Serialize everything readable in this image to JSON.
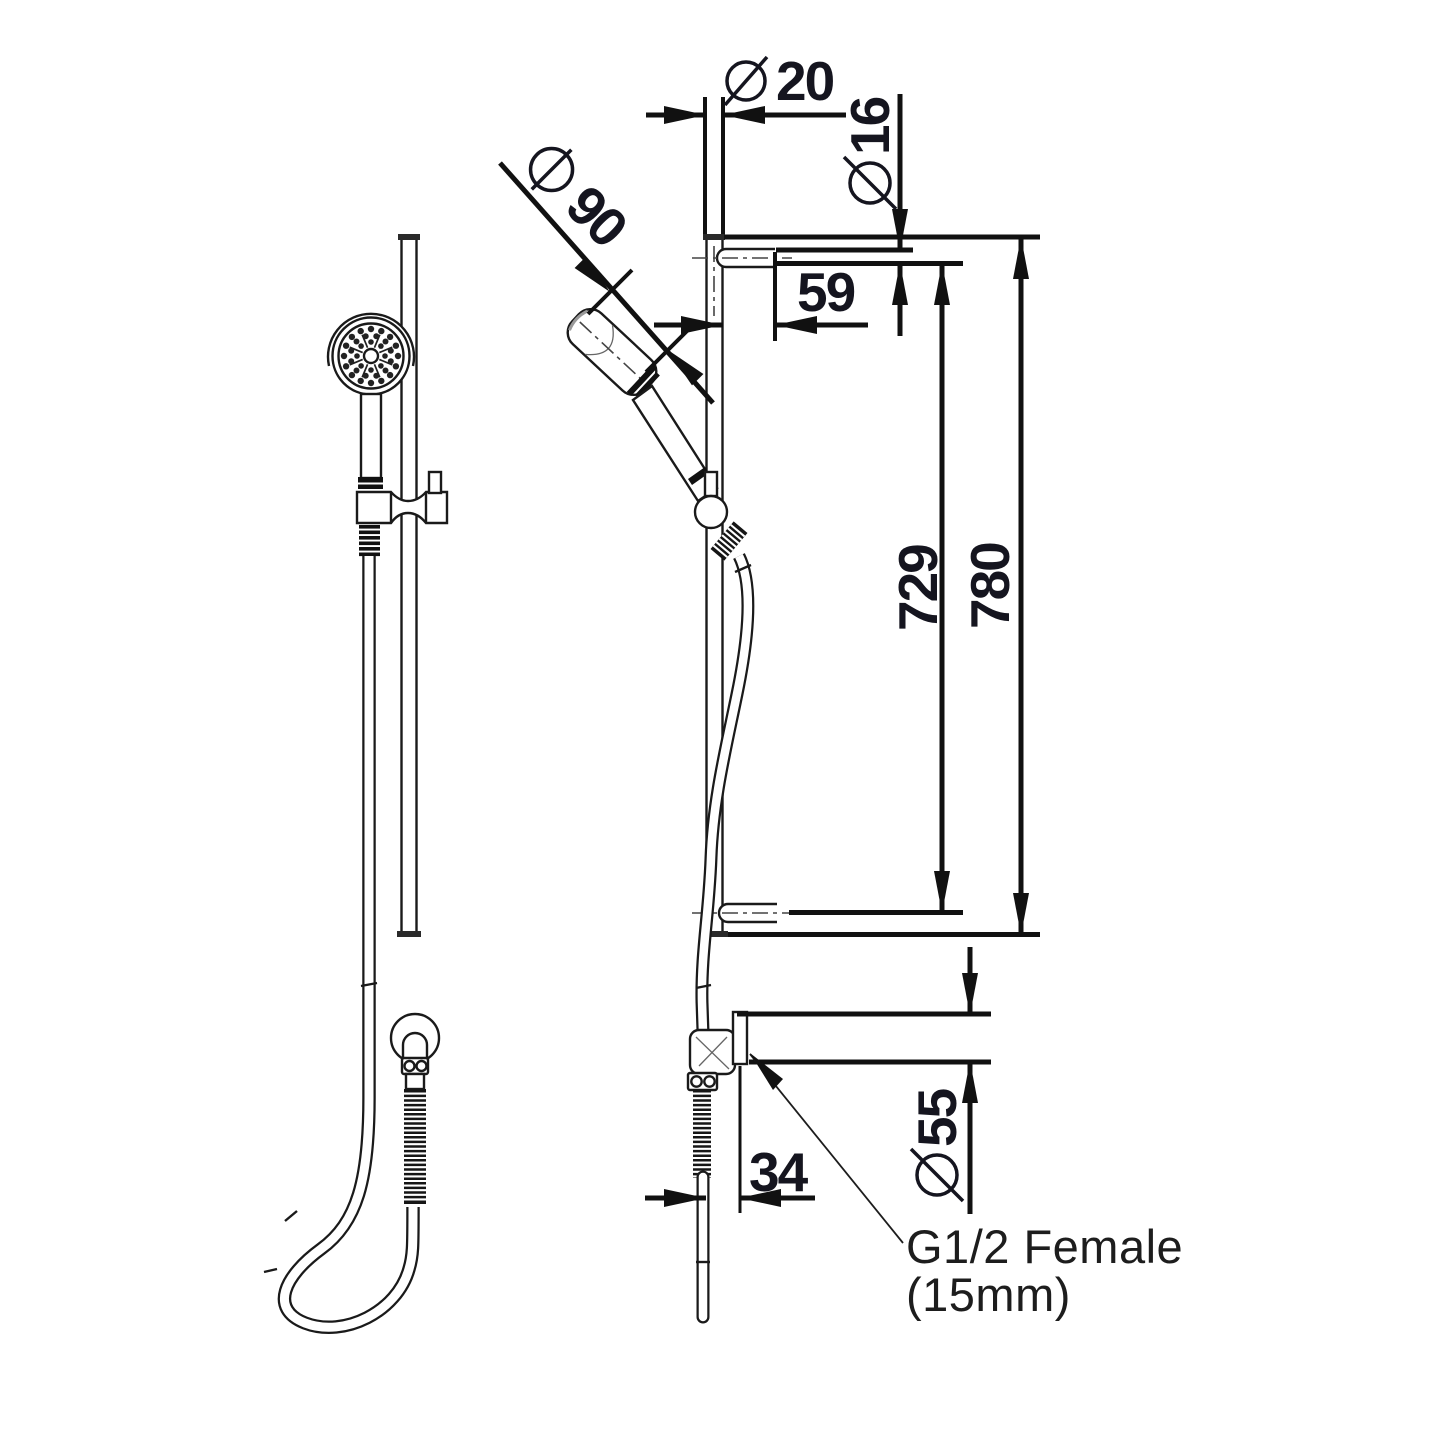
{
  "colors": {
    "background": "#ffffff",
    "line": "#1a1a1a",
    "dimension_text": "#15151f"
  },
  "dimensions": {
    "rail_diameter": {
      "symbol": "Ø",
      "value": "20"
    },
    "arm_diameter": {
      "symbol": "Ø",
      "value": "16"
    },
    "wall_offset": {
      "value": "59"
    },
    "handset_diameter": {
      "symbol": "Ø",
      "value": "90"
    },
    "bracket_spacing": {
      "value": "729"
    },
    "rail_length": {
      "value": "780"
    },
    "outlet_offset": {
      "value": "34"
    },
    "flange_diameter": {
      "symbol": "Ø",
      "value": "55"
    },
    "connection_note": {
      "line1": "G1/2 Female",
      "line2": "(15mm)"
    }
  }
}
